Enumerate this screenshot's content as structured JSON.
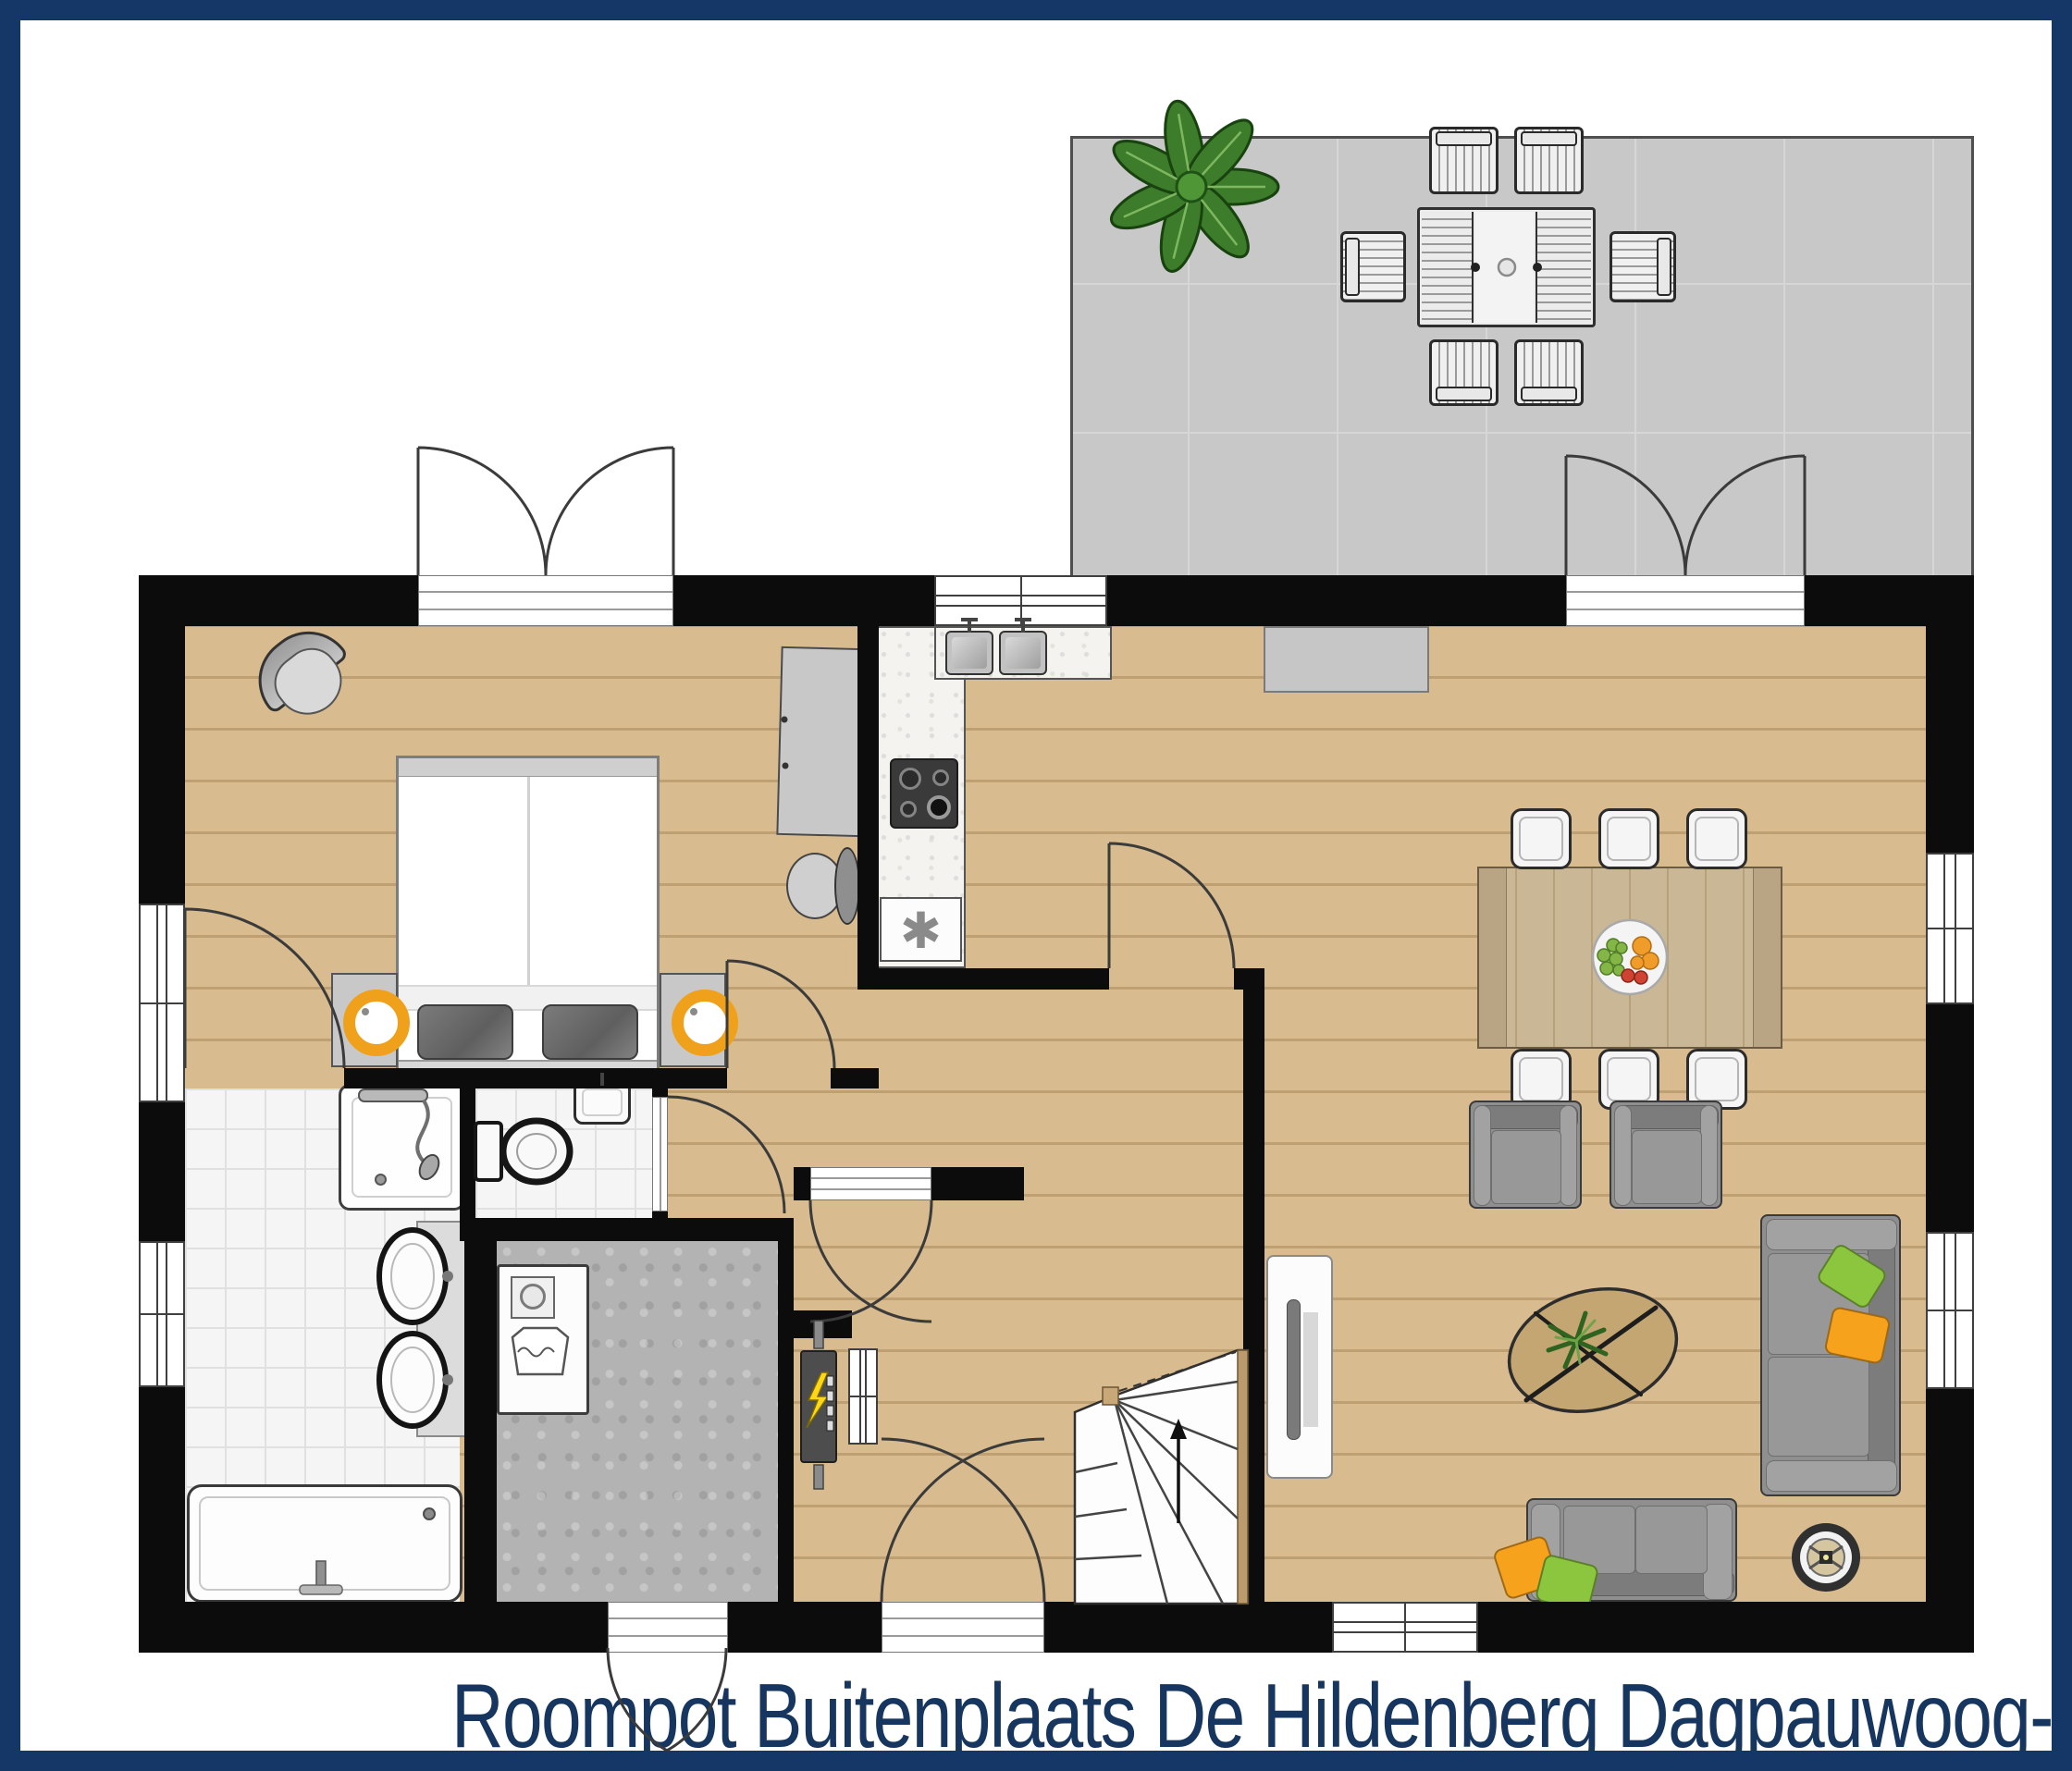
{
  "title": "Roompot Buitenplaats De Hildenberg Dagpauwoog-6",
  "freezer_symbol": "✱",
  "colors": {
    "frame_navy": "#143767",
    "title_navy": "#16365f",
    "wall_black": "#0c0c0c",
    "wood_floor": "#d8bb8e",
    "terrace_tile": "#c8c8c8",
    "bathroom_tile": "#f5f5f5",
    "utility_floor": "#b3b3b3",
    "counter_speckle": "#f4f3ef",
    "sofa_gray": "#8f8f8f",
    "pillow_green": "#8cc63e",
    "pillow_orange": "#f6a21c",
    "lamp_orange": "#f0a11c",
    "plant_green": "#3c7c2b",
    "stair_wood": "#bb9b6b"
  },
  "rooms": [
    {
      "name": "terrace"
    },
    {
      "name": "bedroom"
    },
    {
      "name": "kitchen"
    },
    {
      "name": "living-dining-room"
    },
    {
      "name": "hallway"
    },
    {
      "name": "entrance-hall"
    },
    {
      "name": "bathroom"
    },
    {
      "name": "toilet-room"
    },
    {
      "name": "utility-room"
    }
  ],
  "furniture": {
    "terrace": [
      "outdoor-dining-table",
      "outdoor-chair x6",
      "plant"
    ],
    "bedroom": [
      "double-bed",
      "nightstand x2",
      "bedside-lamp x2",
      "wardrobe",
      "corner-chair",
      "desk-chair"
    ],
    "kitchen": [
      "counter",
      "double-sink",
      "gas-hob",
      "freezer"
    ],
    "living-dining-room": [
      "sideboard",
      "dining-table",
      "fruit-bowl",
      "dining-chair x6",
      "armchair x2",
      "sofa x2",
      "cushion x4",
      "coffee-table",
      "tv-cabinet",
      "tv",
      "robot-vacuum"
    ],
    "bathroom": [
      "shower",
      "double-washbasin",
      "bathtub"
    ],
    "toilet-room": [
      "toilet",
      "washbasin"
    ],
    "utility-room": [
      "washing-machine",
      "electrical-panel"
    ],
    "entrance-hall": [
      "winder-staircase"
    ]
  }
}
